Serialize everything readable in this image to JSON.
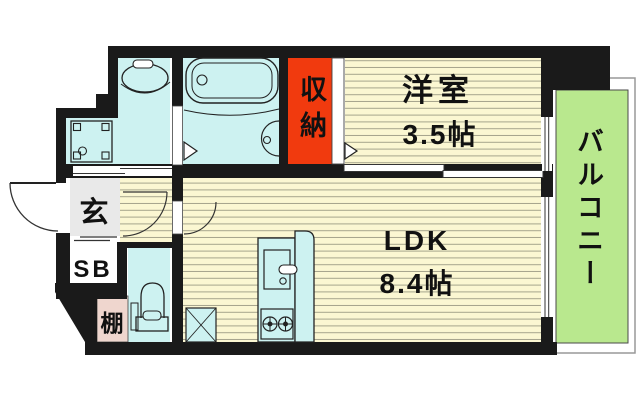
{
  "plan": {
    "title": "apartment-floor-plan",
    "rooms": {
      "western": {
        "label": "洋室",
        "size": "3.5帖"
      },
      "ldk": {
        "label": "LDK",
        "size": "8.4帖"
      },
      "storage": {
        "label": "収納"
      },
      "balcony": {
        "label": "バルコニー"
      },
      "entrance": {
        "label": "玄"
      },
      "shoe_box": {
        "label": "SB"
      },
      "shelf": {
        "label": "棚"
      }
    },
    "colors": {
      "wall": "#1a1a1a",
      "wet_area": "#cdf2f1",
      "flooring": "#fbf7d2",
      "flooring_line": "#a6a58c",
      "storage": "#f13a0e",
      "balcony": "#b9e88e",
      "balcony_text": "#143314",
      "shoe_box": "#f6ef49",
      "shelf": "#efd6ce",
      "entrance_floor": "#e9e9e9",
      "label_text": "#111111",
      "fixture_line": "#222222"
    }
  }
}
